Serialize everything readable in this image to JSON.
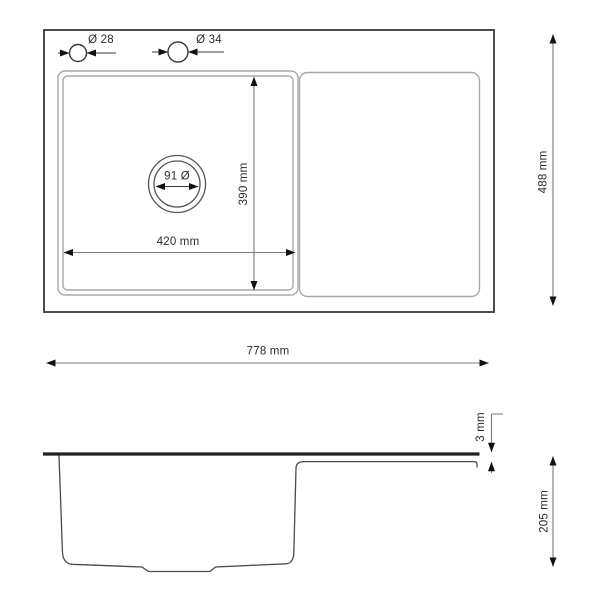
{
  "colors": {
    "frame_line": "#444444",
    "panel_line": "#a9a9a9",
    "profile_line": "#4a4a4a",
    "dimension_line": "#7a7a7a",
    "arrow_fill": "#111111",
    "rim_line": "#222222",
    "text": "#2b2b2b",
    "background": "#ffffff"
  },
  "top_view": {
    "faucet_holes": [
      {
        "label": "Ø 28"
      },
      {
        "label": "Ø 34"
      }
    ],
    "drain": {
      "label": "91 Ø"
    },
    "dimensions": {
      "basin_width": "420 mm",
      "basin_depth": "390 mm",
      "overall_width": "778 mm",
      "overall_depth": "488 mm"
    }
  },
  "side_view": {
    "dimensions": {
      "rim_thickness": "3 mm",
      "bowl_depth": "205 mm"
    }
  }
}
